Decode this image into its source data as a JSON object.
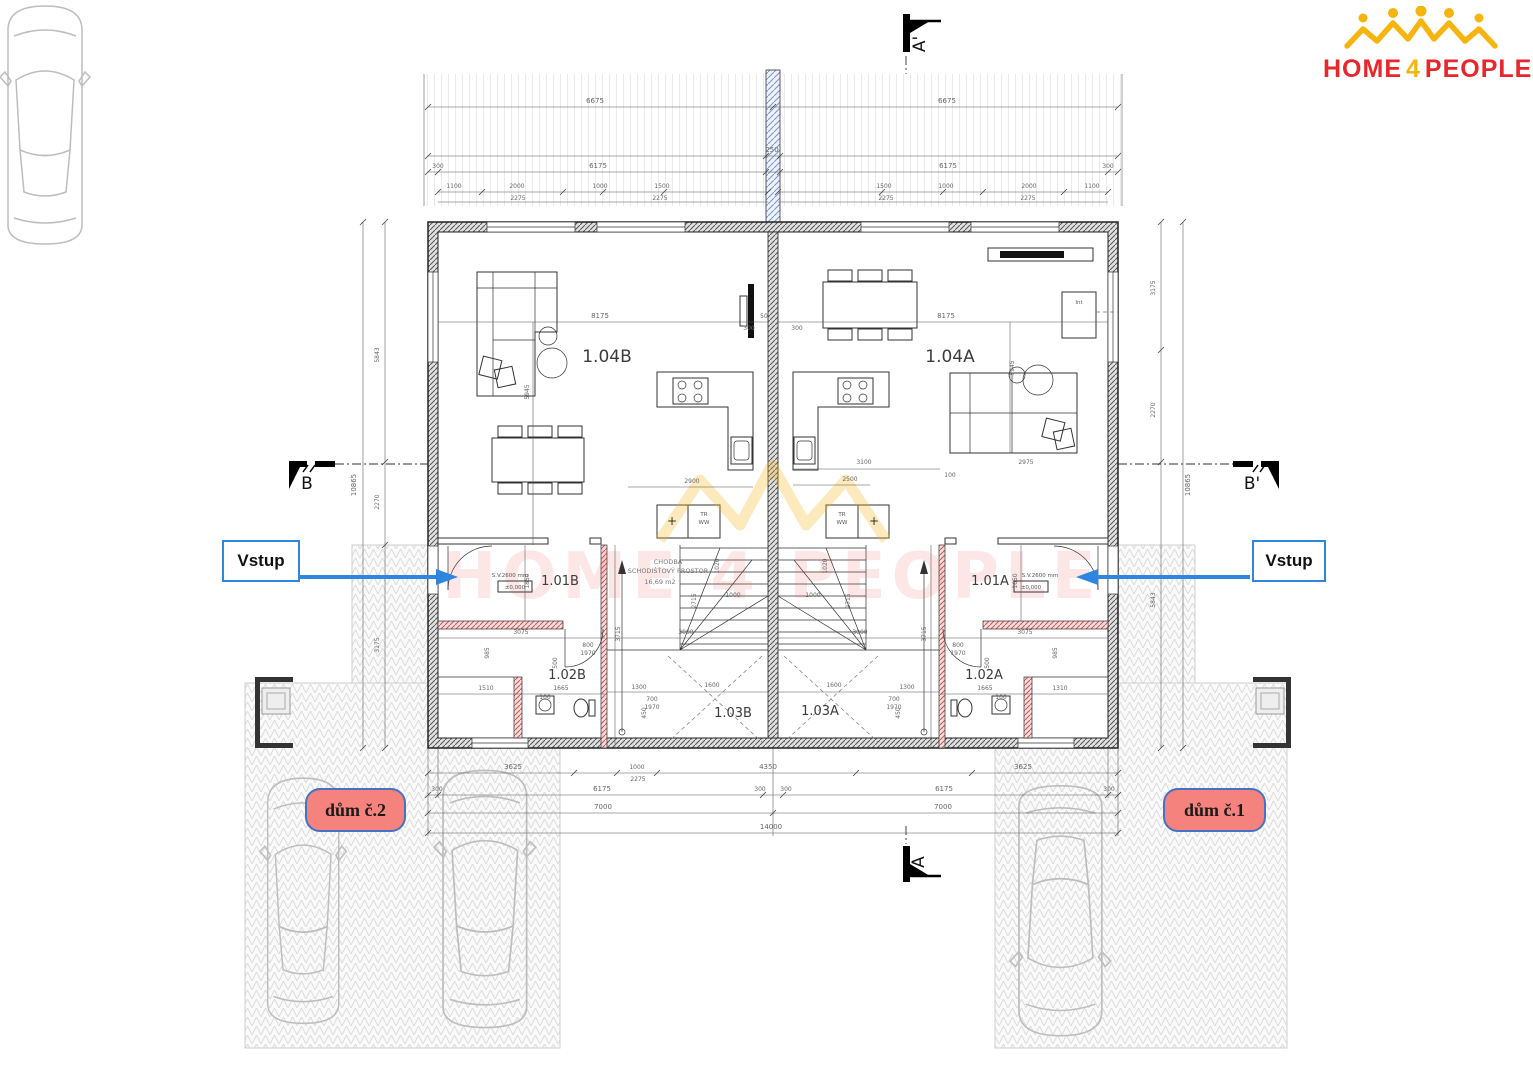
{
  "logo": {
    "home": "HOME",
    "four": "4",
    "people": "PEOPLE"
  },
  "markers": {
    "top": "A'",
    "bottom": "A",
    "left": "B",
    "right": "B'"
  },
  "entry": {
    "left": "Vstup",
    "right": "Vstup"
  },
  "houses": {
    "left": "dům č.2",
    "right": "dům č.1"
  },
  "rooms": {
    "living_b": "1.04B",
    "living_a": "1.04A",
    "hall_b": "1.01B",
    "hall_a": "1.01A",
    "bath_b": "1.02B",
    "bath_a": "1.02A",
    "stair_b": "1.03B",
    "stair_a": "1.03A"
  },
  "annotations": {
    "chodba": "CHODBA",
    "chodba2": "SCHODIŠŤOVÝ PROSTOR",
    "area": "16,69 m2",
    "level": "±0,000",
    "ceiling": "S.V.2600 mm",
    "int": "Int",
    "tr": "TR",
    "ww": "WW",
    "plus": "+"
  },
  "watermark": {
    "text": "HOME 4 PEOPLE"
  },
  "colors": {
    "logo_red": "#e8262b",
    "logo_yellow": "#f6b40e",
    "arrow_blue": "#2e86de",
    "house_fill": "#f5827d",
    "house_border": "#4472c4"
  },
  "dims": {
    "top": [
      "6675",
      "6675",
      "250",
      "300",
      "6175",
      "6175",
      "300",
      "1100",
      "2000",
      "1000",
      "1500",
      "1500",
      "1000",
      "2000",
      "1100",
      "2275",
      "2275",
      "2275",
      "2275"
    ],
    "bottom": [
      "3625",
      "1000",
      "2275",
      "4350",
      "3625",
      "300",
      "6175",
      "300",
      "300",
      "6175",
      "300",
      "7000",
      "7000",
      "14000"
    ],
    "sides": [
      "10865",
      "5843",
      "2270",
      "3175",
      "10865",
      "5843",
      "2270",
      "3175"
    ],
    "inner": [
      "8175",
      "8175",
      "300",
      "300",
      "5945",
      "5945",
      "2900",
      "3100",
      "2500",
      "2975",
      "100",
      "3000",
      "3000",
      "2715",
      "2715",
      "1000",
      "1000",
      "3715",
      "3715",
      "1020",
      "1020",
      "3075",
      "3075",
      "985",
      "985",
      "1510",
      "1310",
      "1665",
      "1665",
      "1300",
      "1300",
      "1850",
      "1650",
      "800",
      "1970",
      "800",
      "1970",
      "700",
      "1970",
      "700",
      "1970",
      "450",
      "450",
      "1600",
      "1600",
      "100",
      "100",
      "500",
      "500",
      "50"
    ]
  }
}
